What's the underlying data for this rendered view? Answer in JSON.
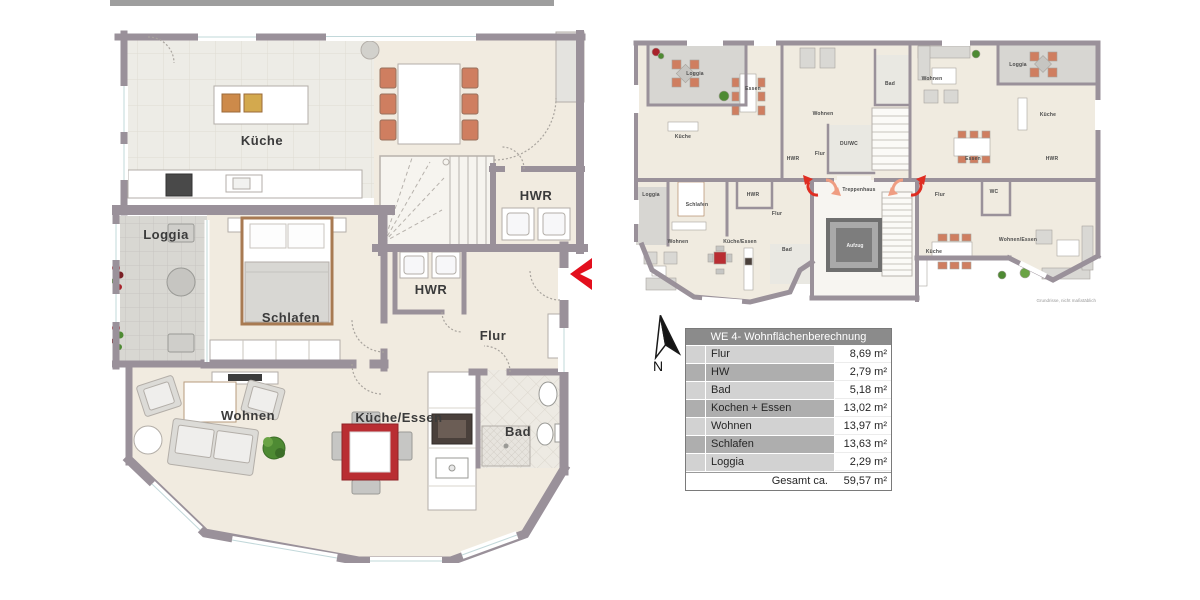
{
  "page": {
    "top_bar_color": "#9e9e9e",
    "background": "#ffffff"
  },
  "colors": {
    "wall": "#9a919a",
    "floor_beige": "#f1ebe0",
    "floor_tile": "#edece6",
    "floor_loggia": "#d8d7d2",
    "accent_red": "#e30f1d",
    "table_red": "#b92d32",
    "chair_orange": "#cf7e60",
    "bed_wood": "#a87a52",
    "table_header_gray": "#8b8b8b",
    "row_light": "#d2d2d2",
    "row_dark": "#aeaeae"
  },
  "main_plan": {
    "labels": [
      {
        "id": "kueche",
        "text": "Küche"
      },
      {
        "id": "hwr-top",
        "text": "HWR"
      },
      {
        "id": "loggia",
        "text": "Loggia"
      },
      {
        "id": "schlafen",
        "text": "Schlafen"
      },
      {
        "id": "hwr",
        "text": "HWR"
      },
      {
        "id": "flur",
        "text": "Flur"
      },
      {
        "id": "wohnen",
        "text": "Wohnen"
      },
      {
        "id": "kueche-essen",
        "text": "Küche/Essen"
      },
      {
        "id": "bad",
        "text": "Bad"
      }
    ],
    "entrance_marker": "left-chevron"
  },
  "overview_plan": {
    "labels": [
      {
        "id": "ov-loggia-tl",
        "text": "Loggia"
      },
      {
        "id": "ov-essen-tl",
        "text": "Essen"
      },
      {
        "id": "ov-kueche-tl",
        "text": "Küche"
      },
      {
        "id": "ov-wohnen-ct",
        "text": "Wohnen"
      },
      {
        "id": "ov-duwc-ct",
        "text": "DU/WC"
      },
      {
        "id": "ov-flur-ct",
        "text": "Flur"
      },
      {
        "id": "ov-hwr-ct",
        "text": "HWR"
      },
      {
        "id": "ov-bad-tr",
        "text": "Bad"
      },
      {
        "id": "ov-wohnen-tr",
        "text": "Wohnen"
      },
      {
        "id": "ov-loggia-tr",
        "text": "Loggia"
      },
      {
        "id": "ov-kueche-tr",
        "text": "Küche"
      },
      {
        "id": "ov-essen-tr",
        "text": "Essen"
      },
      {
        "id": "ov-hwr-tr",
        "text": "HWR"
      },
      {
        "id": "ov-treppenhaus",
        "text": "Treppenhaus"
      },
      {
        "id": "ov-aufzug",
        "text": "Aufzug"
      },
      {
        "id": "ov-loggia-we4",
        "text": "Loggia"
      },
      {
        "id": "ov-schlafen-we4",
        "text": "Schlafen"
      },
      {
        "id": "ov-hwr-we4",
        "text": "HWR"
      },
      {
        "id": "ov-flur-we4",
        "text": "Flur"
      },
      {
        "id": "ov-wohnen-we4",
        "text": "Wohnen"
      },
      {
        "id": "ov-kueche-essen-we4",
        "text": "Küche/Essen"
      },
      {
        "id": "ov-bad-we4",
        "text": "Bad"
      },
      {
        "id": "ov-flur-br",
        "text": "Flur"
      },
      {
        "id": "ov-wc-br",
        "text": "WC"
      },
      {
        "id": "ov-kueche-br",
        "text": "Küche"
      },
      {
        "id": "ov-wohnen-essen-br",
        "text": "Wohnen/Essen"
      }
    ],
    "caption": "Grundrisse, nicht maßstäblich"
  },
  "compass": {
    "label": "N"
  },
  "area_table": {
    "title": "WE 4- Wohnflächenberechnung",
    "rows": [
      {
        "label": "Flur",
        "value": "8,69 m²"
      },
      {
        "label": "HW",
        "value": "2,79 m²"
      },
      {
        "label": "Bad",
        "value": "5,18 m²"
      },
      {
        "label": "Kochen + Essen",
        "value": "13,02 m²"
      },
      {
        "label": "Wohnen",
        "value": "13,97 m²"
      },
      {
        "label": "Schlafen",
        "value": "13,63 m²"
      },
      {
        "label": "Loggia",
        "value": "2,29 m²"
      }
    ],
    "total_label": "Gesamt ca.",
    "total_value": "59,57 m²"
  }
}
